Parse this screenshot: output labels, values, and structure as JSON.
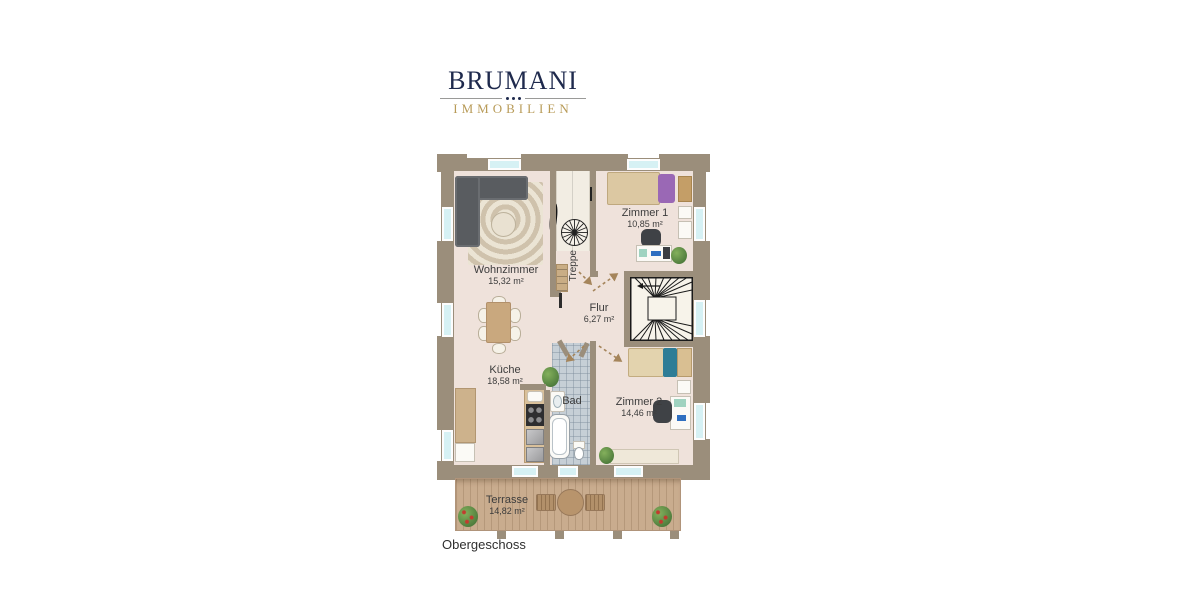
{
  "logo": {
    "brand": "BRUMANI",
    "subtitle": "IMMOBILIEN"
  },
  "plan": {
    "floor_label": "Obergeschoss",
    "rooms": {
      "wohnzimmer": {
        "name": "Wohnzimmer",
        "area": "15,32 m²"
      },
      "kueche": {
        "name": "Küche",
        "area": "18,58 m²"
      },
      "flur": {
        "name": "Flur",
        "area": "6,27 m²"
      },
      "bad": {
        "name": "Bad"
      },
      "treppe": {
        "name": "Treppe"
      },
      "zimmer1": {
        "name": "Zimmer 1",
        "area": "10,85 m²"
      },
      "zimmer2": {
        "name": "Zimmer 2",
        "area": "14,46 m²"
      },
      "terrasse": {
        "name": "Terrasse",
        "area": "14,82 m²"
      }
    },
    "colors": {
      "wall": "#9b8e7b",
      "floor": "#efe2db",
      "window_glass": "#d6f1f4",
      "terrace_wood": "#c9ac8e",
      "bath_tile": "#c6cfd6",
      "logo_navy": "#1f2a4d",
      "logo_gold": "#b89b58",
      "accent_purple": "#9a68b5",
      "accent_teal": "#2e7d96"
    }
  }
}
